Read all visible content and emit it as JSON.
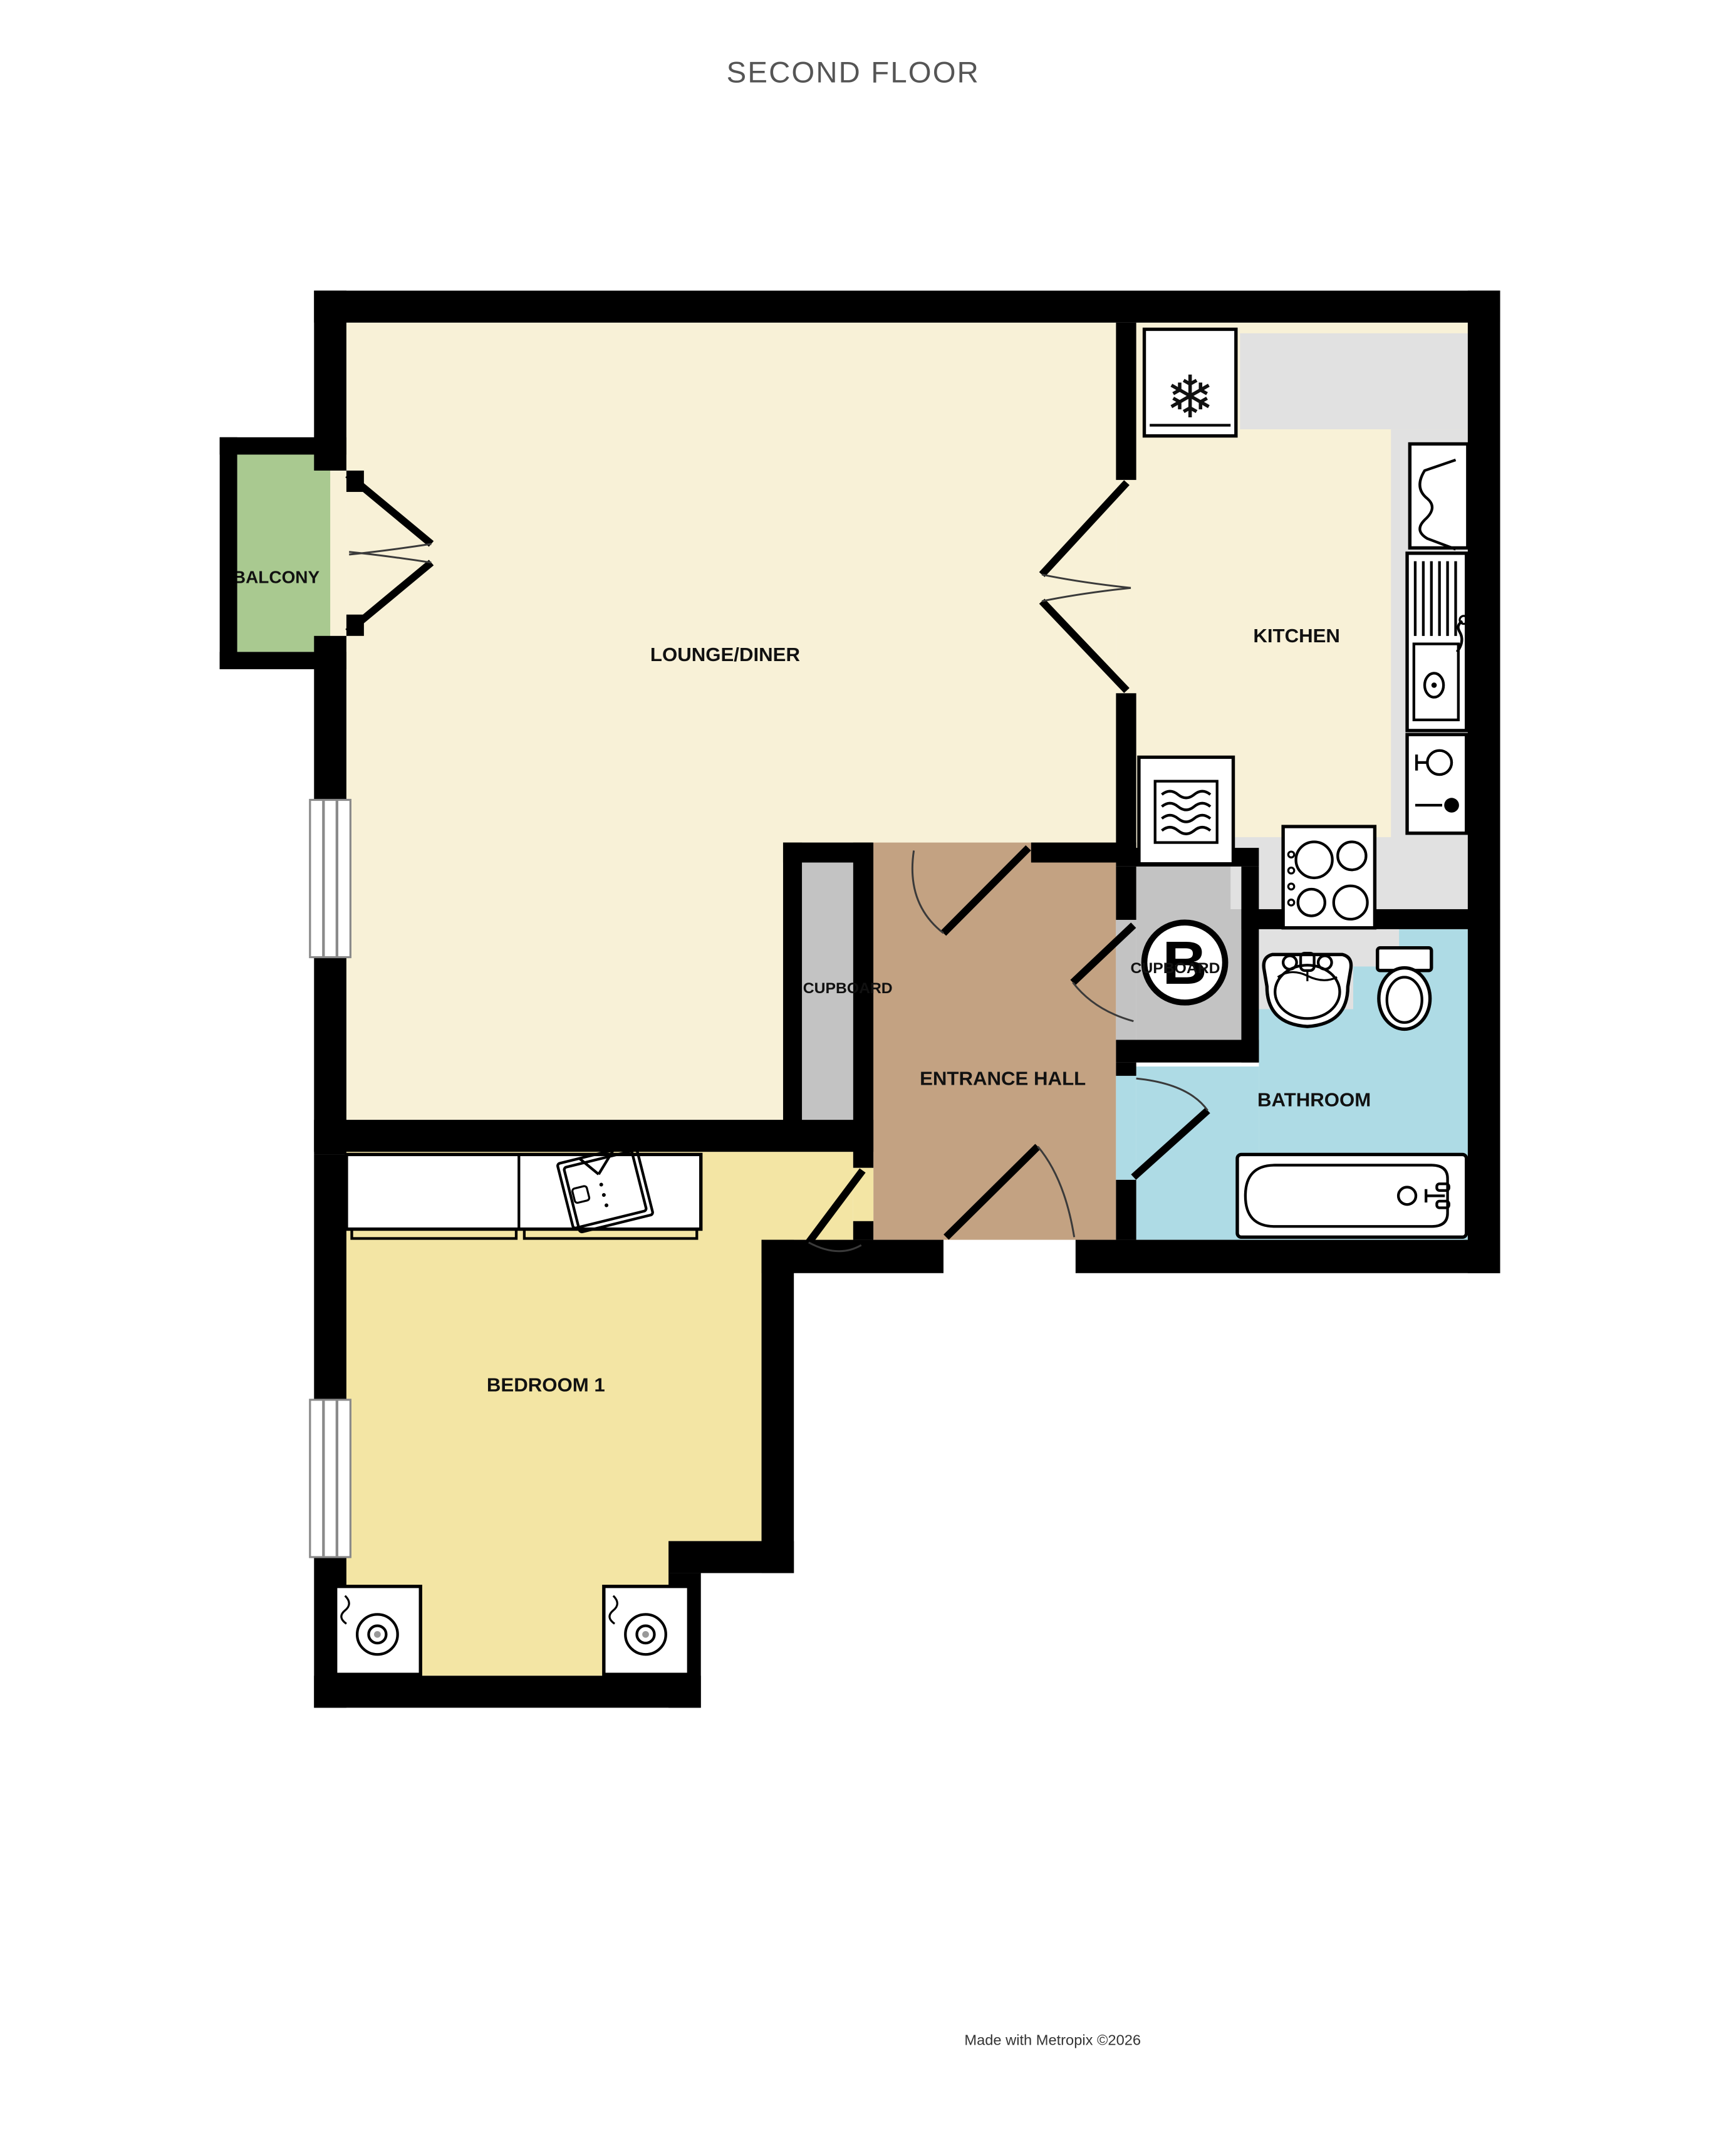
{
  "title": "SECOND FLOOR",
  "footer": "Made with Metropix ©2026",
  "rooms": {
    "balcony": {
      "label": "BALCONY"
    },
    "lounge": {
      "label": "LOUNGE/DINER"
    },
    "kitchen": {
      "label": "KITCHEN"
    },
    "cupboard_left": {
      "label": "CUPBOARD"
    },
    "entrance_hall": {
      "label": "ENTRANCE HALL"
    },
    "cupboard_boiler": {
      "label": "CUPBOARD",
      "symbol": "B"
    },
    "bathroom": {
      "label": "BATHROOM"
    },
    "bedroom": {
      "label": "BEDROOM 1"
    }
  },
  "icons": {
    "fridge_freezer_snowflake": "❄",
    "oven": "microwave-waves-icon",
    "hob": "four-burner-hob-icon",
    "sink": "sink-drainer-tap-icon",
    "dishwasher": "glass-icon",
    "wardrobe": "folded-shirt-icon",
    "speakers": "speaker-icon",
    "boiler": "circled-B"
  },
  "colors": {
    "wall": "#000000",
    "floor_lounge": "#f8f1d7",
    "floor_kitchen": "#f8f1d7",
    "floor_bedroom": "#f3e5a4",
    "floor_hall": "#c3a282",
    "floor_bathroom": "#aedbe5",
    "floor_balcony": "#a9c990",
    "counter_gray": "#e1e1e1",
    "cupboard_gray": "#c3c3c3",
    "fixture_white": "#ffffff",
    "title_gray": "#555555"
  }
}
